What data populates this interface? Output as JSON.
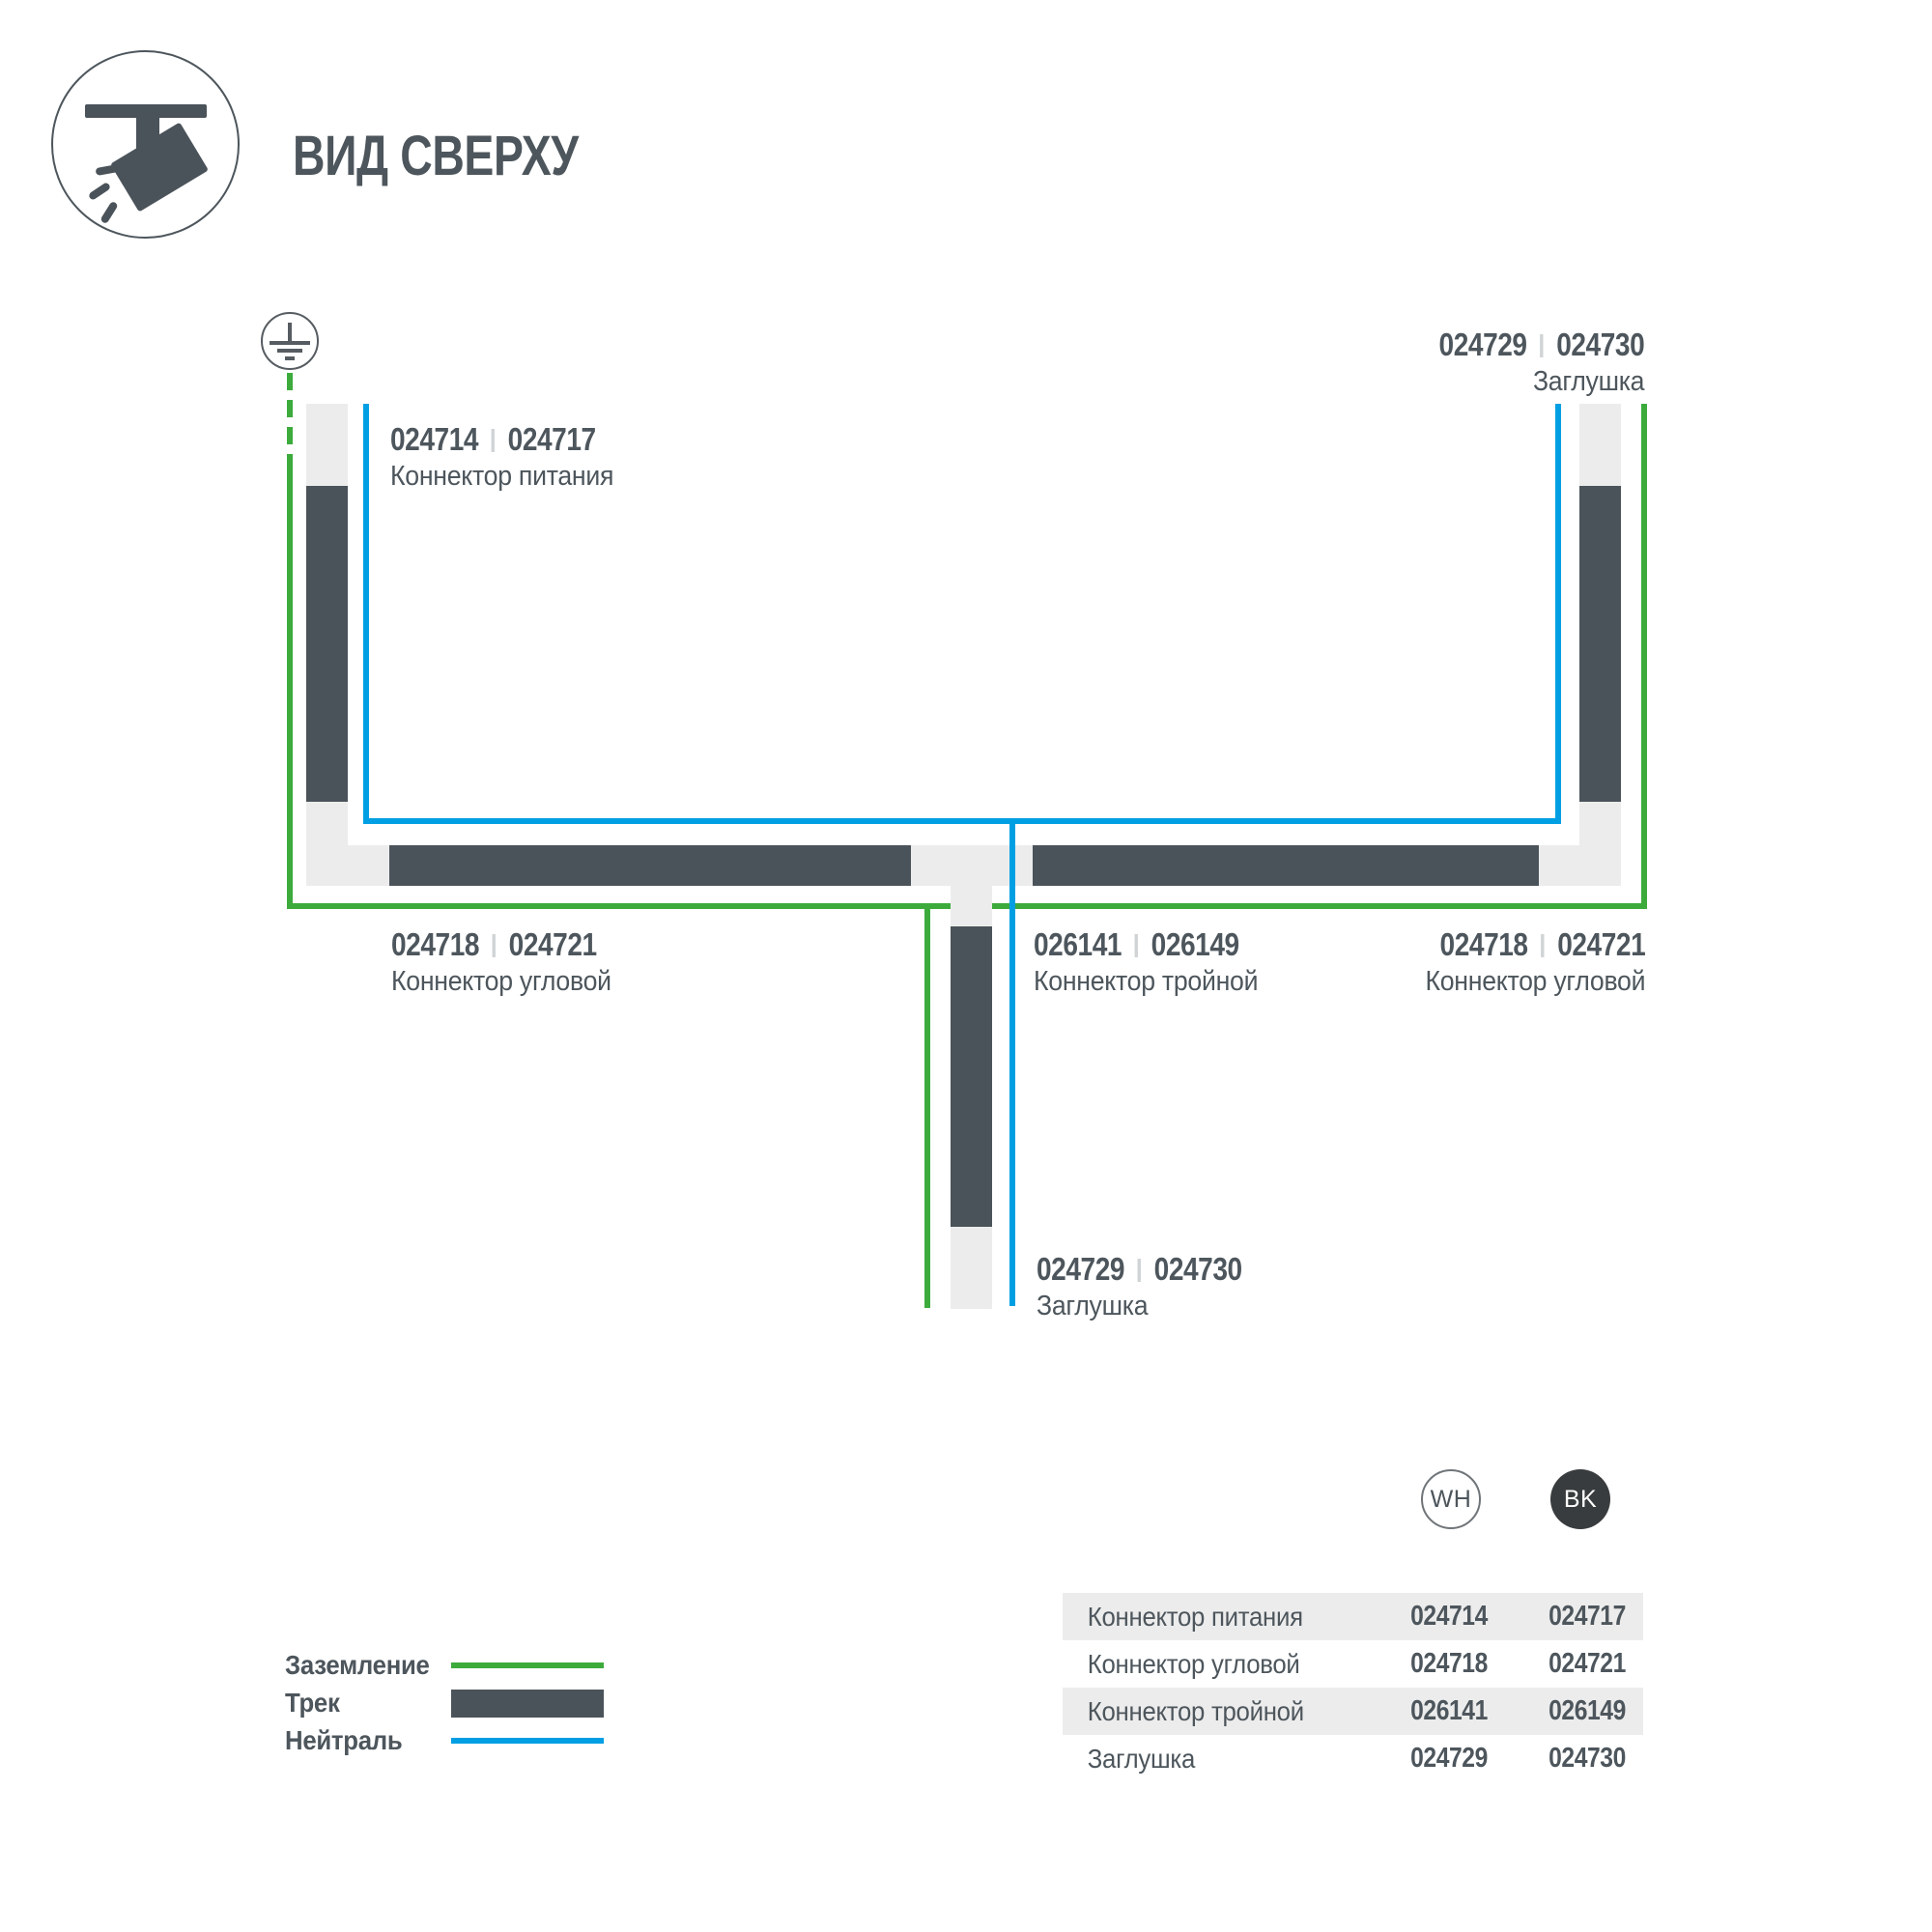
{
  "colors": {
    "track_dark": "#4b535a",
    "track_light": "#ececec",
    "ground_green": "#3cab3c",
    "neutral_blue": "#009fe3",
    "text": "#4d565c"
  },
  "header": {
    "title": "ВИД СВЕРХУ"
  },
  "diagram": {
    "labels": {
      "power": {
        "wh": "024714",
        "bk": "024717",
        "name": "Коннектор питания"
      },
      "endcap_top": {
        "wh": "024729",
        "bk": "024730",
        "name": "Заглушка"
      },
      "corner_left": {
        "wh": "024718",
        "bk": "024721",
        "name": "Коннектор угловой"
      },
      "triple": {
        "wh": "026141",
        "bk": "026149",
        "name": "Коннектор тройной"
      },
      "corner_right": {
        "wh": "024718",
        "bk": "024721",
        "name": "Коннектор угловой"
      },
      "endcap_bottom": {
        "wh": "024729",
        "bk": "024730",
        "name": "Заглушка"
      }
    }
  },
  "legend": {
    "ground": "Заземление",
    "track": "Трек",
    "neutral": "Нейтраль"
  },
  "variants": {
    "white": "WH",
    "black": "BK"
  },
  "table": {
    "rows": [
      {
        "name": "Коннектор питания",
        "wh": "024714",
        "bk": "024717"
      },
      {
        "name": "Коннектор угловой",
        "wh": "024718",
        "bk": "024721"
      },
      {
        "name": "Коннектор тройной",
        "wh": "026141",
        "bk": "026149"
      },
      {
        "name": "Заглушка",
        "wh": "024729",
        "bk": "024730"
      }
    ]
  }
}
